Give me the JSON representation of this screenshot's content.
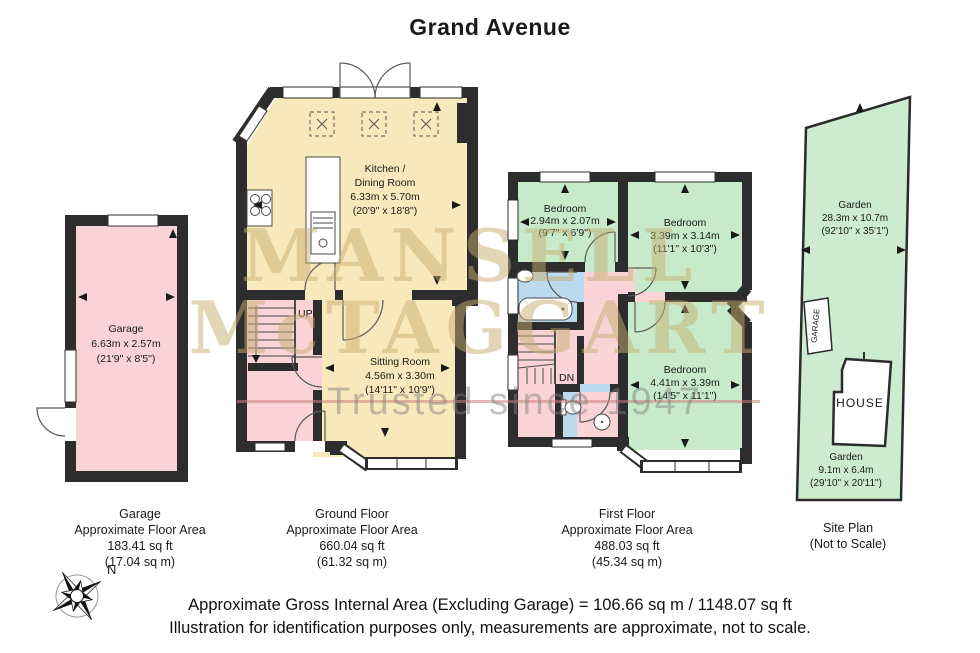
{
  "title": "Grand Avenue",
  "watermark": {
    "brand_top": "MANSELL",
    "brand_bottom": "McTAGGART",
    "tagline": "Trusted since 1947"
  },
  "compass": {
    "north": "N"
  },
  "garage_plan": {
    "room_name": "Garage",
    "dim_metric": "6.63m x 2.57m",
    "dim_imperial": "(21'9\" x 8'5\")",
    "caption_title": "Garage",
    "caption_sub": "Approximate Floor Area",
    "caption_sqft": "183.41 sq ft",
    "caption_sqm": "(17.04 sq m)"
  },
  "ground_floor": {
    "kitchen_name_1": "Kitchen /",
    "kitchen_name_2": "Dining Room",
    "kitchen_metric": "6.33m x 5.70m",
    "kitchen_imperial": "(20'9\" x 18'8\")",
    "sitting_name": "Sitting Room",
    "sitting_metric": "4.56m x 3.30m",
    "sitting_imperial": "(14'11\" x 10'9\")",
    "stairs": "UP",
    "caption_title": "Ground Floor",
    "caption_sub": "Approximate Floor Area",
    "caption_sqft": "660.04 sq ft",
    "caption_sqm": "(61.32 sq m)"
  },
  "first_floor": {
    "bedroom1_name": "Bedroom",
    "bedroom1_metric": "2.94m x 2.07m",
    "bedroom1_imperial": "(9'7\" x 6'9\")",
    "bedroom2_name": "Bedroom",
    "bedroom2_metric": "3.39m x 3.14m",
    "bedroom2_imperial": "(11'1\" x 10'3\")",
    "bedroom3_name": "Bedroom",
    "bedroom3_metric": "4.41m x 3.39m",
    "bedroom3_imperial": "(14'5\" x 11'1\")",
    "stairs": "DN",
    "caption_title": "First Floor",
    "caption_sub": "Approximate Floor Area",
    "caption_sqft": "488.03 sq ft",
    "caption_sqm": "(45.34 sq m)"
  },
  "site_plan": {
    "garden_rear_name": "Garden",
    "garden_rear_metric": "28.3m x 10.7m",
    "garden_rear_imperial": "(92'10\" x 35'1\")",
    "garden_front_name": "Garden",
    "garden_front_metric": "9.1m x 6.4m",
    "garden_front_imperial": "(29'10\" x 20'11\")",
    "garage_label": "GARAGE",
    "house_label": "HOUSE",
    "caption_title": "Site Plan",
    "caption_sub": "(Not to Scale)"
  },
  "footer": {
    "line1": "Approximate Gross Internal Area (Excluding Garage) = 106.66 sq m / 1148.07 sq ft",
    "line2": "Illustration for identification purposes only, measurements are approximate, not to scale."
  },
  "colors": {
    "wall": "#2d2d2d",
    "garage_fill": "#f9d3d6",
    "living_fill": "#f8e9bc",
    "bedroom_fill": "#c7ebca",
    "bath_fill": "#bcdaee",
    "garden_fill": "#cdeccf",
    "watermark_gold": "#c7ad70",
    "watermark_gray": "#7d7d7d",
    "watermark_line": "#ce8080"
  }
}
